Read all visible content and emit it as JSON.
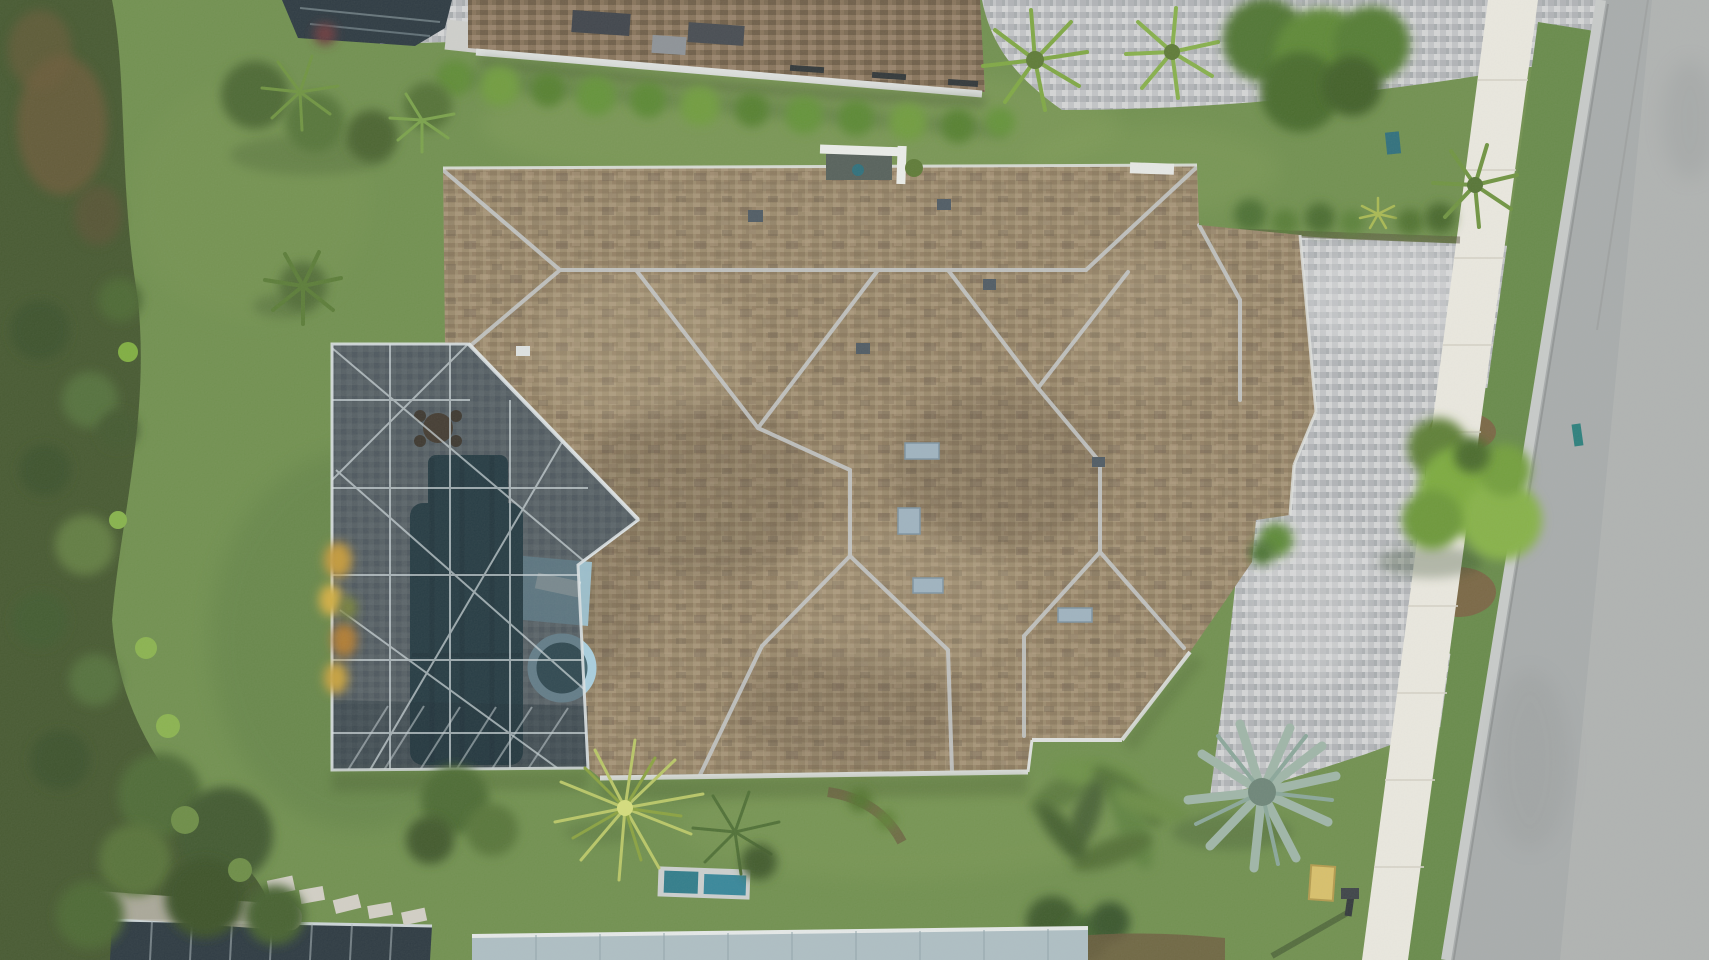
{
  "meta": {
    "type": "aerial-drone-photograph",
    "subject": "Top-down view of a single-family home with tan shingle hip roof, attached screened pool enclosure with pool and spa, paver driveway with grass island and tree, sidewalk and asphalt street on the right, lawns, hedges, palms and a wild vegetation strip on the left",
    "view": "orthographic top-down",
    "width_px": 1709,
    "height_px": 960
  },
  "palette": {
    "lawn": "#70904e",
    "lawn_light": "#8ba55f",
    "lawn_dark": "#678a49",
    "wild_vegetation": "#45582f",
    "wild_brown": "#6b5a38",
    "hedge_green": "#639134",
    "tree_bright": "#7cab3e",
    "tree_dark": "#4a6b2c",
    "roof_shingle": "#9b8a6c",
    "roof_shingle_dark": "#7e6d57",
    "ridge_gray": "#c6cacc",
    "gutter_white": "#e0e3e0",
    "neighbor_roof": "#87735a",
    "cage_screen_overlay": "rgba(26,39,47,0.50)",
    "cage_frame": "#cfd9dc",
    "pool_water": "#2c4a52",
    "spa_ring": "#a9cfdf",
    "spa_water": "#41656f",
    "sun_shelf": "#9cc2d2",
    "lounger": "#d4e6ea",
    "deck_paver": "#8f9497",
    "driveway_paver": "#c3c5c7",
    "sidewalk": "#ebe9e0",
    "road": "#a8acac",
    "road_light": "#b6b9b8",
    "curb": "#c8cbca",
    "mulch": "#7b6243",
    "ac_unit_teal": "#2f7c8a",
    "utility_marker_teal": "#2a7f7c",
    "utility_box_yellow": "#d9c06a",
    "metal_roof_gray": "#aebfc4",
    "lanai_screen_dark": "#2b3840",
    "skylight_blue": "#9fb3c0",
    "croton_gold": "#c8a23c",
    "yucca_yellow_green": "#b9c766",
    "bismarck_silver": "#9fb6a8"
  },
  "scene": {
    "regions": [
      {
        "name": "main-house-roof",
        "desc": "large tan/brown shingle hip roof with light gray ridge caps, valleys, skylights and vents",
        "fill": "roof_shingle"
      },
      {
        "name": "pool-enclosure",
        "desc": "dark screened cage over paver deck, rectangular pool, round spa with light blue ring, sun shelf with lounger, patio table",
        "fill": "cage_screen_overlay"
      },
      {
        "name": "driveway",
        "desc": "light gray paver driveway on right side with flared apron to street",
        "fill": "driveway_paver"
      },
      {
        "name": "grass-island",
        "desc": "rounded grass island in driveway apron with large bright green tree and mulch patches",
        "fill": "lawn_dark"
      },
      {
        "name": "sidewalk",
        "desc": "white concrete sidewalk running top to bottom, slightly slanted",
        "fill": "sidewalk"
      },
      {
        "name": "street",
        "desc": "gray asphalt road along right edge with concrete curb and gutter",
        "fill": "road"
      },
      {
        "name": "left-vegetation-strip",
        "desc": "wild dense shrub/preserve border along the left edge",
        "fill": "wild_vegetation"
      },
      {
        "name": "neighbor-roof-top",
        "desc": "neighboring house roof across top with white gutter, skylights and hedge row",
        "fill": "neighbor_roof"
      },
      {
        "name": "neighbor-lanai-top-left",
        "desc": "corner of neighbor screened lanai at top left",
        "fill": "lanai_screen_dark"
      },
      {
        "name": "bottom-neighbor-metal-roof",
        "desc": "light blue-gray roof edge of house at bottom",
        "fill": "metal_roof_gray"
      },
      {
        "name": "bottom-neighbor-cage",
        "desc": "dark screened cage edge at bottom left",
        "fill": "lanai_screen_dark"
      },
      {
        "name": "ac-equipment-pad",
        "desc": "concrete pad with two teal AC units behind house",
        "fill": "ac_unit_teal"
      },
      {
        "name": "yucca-plant",
        "desc": "spiky yellow-green yucca below pool cage",
        "fill": "yucca_yellow_green"
      },
      {
        "name": "bismarck-palm",
        "desc": "silver-blue fan palm at bottom right of house",
        "fill": "bismarck_silver"
      },
      {
        "name": "banana-cluster",
        "desc": "broad-leaf tropical plants at bottom center-right",
        "fill": "hedge_green"
      },
      {
        "name": "croton-plant",
        "desc": "gold/orange croton foliage against pool cage left wall",
        "fill": "croton_gold"
      },
      {
        "name": "mailbox",
        "desc": "mailbox at curb with long shadow",
        "fill": "lanai_screen_dark"
      },
      {
        "name": "utility-box",
        "desc": "small yellow utility box near curb lawn",
        "fill": "utility_box_yellow"
      },
      {
        "name": "utility-markers",
        "desc": "small teal utility markers in lawn and at curb",
        "fill": "utility_marker_teal"
      },
      {
        "name": "stepping-stones",
        "desc": "stepping stone path at bottom left lawn",
        "fill": "sidewalk"
      },
      {
        "name": "entry-courtyard",
        "desc": "small white-walled entry feature on upper roof edge",
        "fill": "gutter_white"
      },
      {
        "name": "hedges-and-palms",
        "desc": "bright hedges and palms along top and top-right paver areas",
        "fill": "hedge_green"
      }
    ]
  }
}
